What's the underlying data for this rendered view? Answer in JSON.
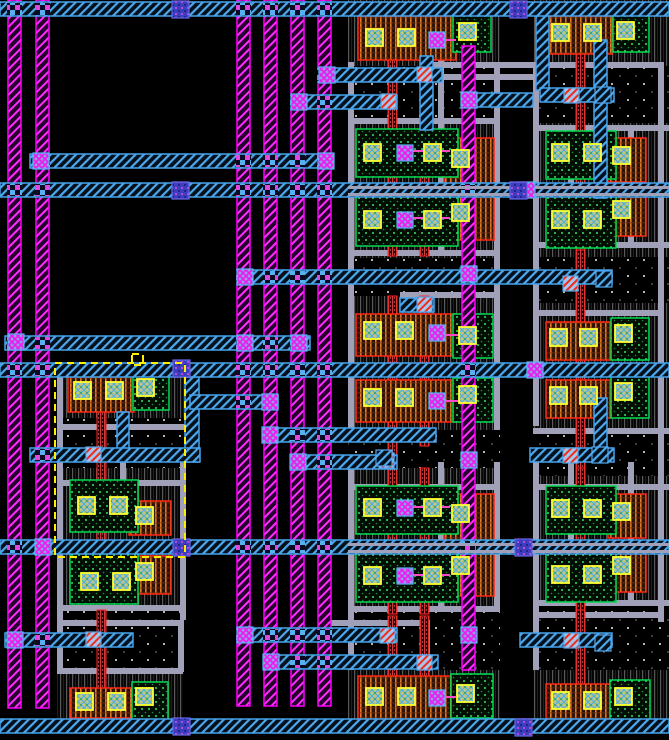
{
  "canvas": {
    "width": 669,
    "height": 740,
    "background": "#000000"
  },
  "palette": {
    "metal2_magenta": "#ff00ff",
    "metal1_cyan": "#46a4ec",
    "routing_gray": "#a0a0b8",
    "poly_red": "#ff2424",
    "pmos_orange": "#e07824",
    "nmos_green": "#00dc50",
    "contact_yellow": "#ffff30",
    "via3_indigo": "#3d3dc0",
    "selection_yellow": "#ffee00",
    "background": "#000000"
  },
  "layers": {
    "wells": [
      [
        348,
        0,
        152,
        66
      ],
      [
        533,
        0,
        136,
        66
      ],
      [
        348,
        118,
        152,
        140
      ],
      [
        533,
        123,
        136,
        134
      ],
      [
        348,
        296,
        152,
        134
      ],
      [
        533,
        303,
        136,
        130
      ],
      [
        348,
        468,
        152,
        142
      ],
      [
        533,
        476,
        136,
        130
      ],
      [
        348,
        670,
        152,
        58
      ],
      [
        533,
        670,
        136,
        58
      ],
      [
        57,
        364,
        128,
        54
      ],
      [
        57,
        468,
        128,
        142
      ],
      [
        57,
        670,
        126,
        50
      ]
    ],
    "stipples": [
      [
        348,
        66,
        152,
        52
      ],
      [
        533,
        66,
        136,
        57
      ],
      [
        348,
        258,
        152,
        38
      ],
      [
        533,
        257,
        136,
        46
      ],
      [
        348,
        430,
        152,
        38
      ],
      [
        533,
        433,
        136,
        43
      ],
      [
        348,
        610,
        152,
        60
      ],
      [
        533,
        606,
        136,
        64
      ],
      [
        57,
        418,
        128,
        50
      ],
      [
        57,
        610,
        128,
        60
      ]
    ],
    "grayH": [
      [
        428,
        62,
        235
      ],
      [
        428,
        74,
        118
      ],
      [
        348,
        118,
        152
      ],
      [
        348,
        250,
        152
      ],
      [
        533,
        125,
        136
      ],
      [
        533,
        242,
        136
      ],
      [
        348,
        484,
        152
      ],
      [
        348,
        606,
        152
      ],
      [
        533,
        484,
        136
      ],
      [
        533,
        600,
        136
      ],
      [
        57,
        424,
        128
      ],
      [
        57,
        480,
        126
      ],
      [
        57,
        605,
        126
      ],
      [
        57,
        620,
        126
      ],
      [
        57,
        668,
        126
      ],
      [
        330,
        620,
        98
      ],
      [
        533,
        612,
        127
      ],
      [
        400,
        292,
        94
      ],
      [
        533,
        310,
        127
      ],
      [
        533,
        428,
        136
      ]
    ],
    "grayV": [
      [
        348,
        62,
        366
      ],
      [
        348,
        462,
        208
      ],
      [
        494,
        62,
        368
      ],
      [
        494,
        462,
        148
      ],
      [
        438,
        56,
        196
      ],
      [
        438,
        462,
        148
      ],
      [
        533,
        62,
        364
      ],
      [
        533,
        462,
        208
      ],
      [
        658,
        62,
        560
      ],
      [
        568,
        125,
        120
      ],
      [
        568,
        462,
        140
      ],
      [
        628,
        125,
        120
      ],
      [
        628,
        462,
        140
      ],
      [
        57,
        364,
        256
      ],
      [
        180,
        462,
        158
      ],
      [
        57,
        620,
        52
      ],
      [
        178,
        620,
        52
      ],
      [
        120,
        424,
        60
      ],
      [
        424,
        620,
        52
      ]
    ],
    "redpolys": [
      [
        388,
        16,
        9,
        114
      ],
      [
        420,
        16,
        9,
        114
      ],
      [
        388,
        130,
        9,
        126
      ],
      [
        420,
        130,
        9,
        126
      ],
      [
        388,
        296,
        9,
        172
      ],
      [
        420,
        296,
        9,
        150
      ],
      [
        388,
        468,
        9,
        146
      ],
      [
        420,
        468,
        9,
        146
      ],
      [
        388,
        616,
        9,
        106
      ],
      [
        420,
        616,
        9,
        106
      ],
      [
        576,
        16,
        9,
        118
      ],
      [
        576,
        134,
        9,
        116
      ],
      [
        576,
        250,
        9,
        218
      ],
      [
        576,
        468,
        9,
        142
      ],
      [
        576,
        610,
        9,
        112
      ],
      [
        97,
        374,
        9,
        186
      ],
      [
        97,
        610,
        9,
        110
      ]
    ],
    "pboxes": [
      [
        358,
        16,
        98,
        44
      ],
      [
        444,
        138,
        50,
        50
      ],
      [
        444,
        192,
        50,
        48
      ],
      [
        356,
        314,
        100,
        42
      ],
      [
        356,
        380,
        100,
        42
      ],
      [
        444,
        494,
        50,
        50
      ],
      [
        444,
        548,
        50,
        48
      ],
      [
        358,
        676,
        98,
        44
      ],
      [
        546,
        16,
        66,
        38
      ],
      [
        608,
        138,
        38,
        44
      ],
      [
        608,
        192,
        38,
        44
      ],
      [
        546,
        322,
        64,
        38
      ],
      [
        546,
        380,
        64,
        38
      ],
      [
        608,
        494,
        38,
        44
      ],
      [
        608,
        548,
        38,
        44
      ],
      [
        546,
        684,
        66,
        38
      ],
      [
        68,
        374,
        66,
        38
      ],
      [
        129,
        501,
        42,
        34
      ],
      [
        129,
        556,
        42,
        38
      ],
      [
        70,
        688,
        64,
        30
      ]
    ],
    "gboxes": [
      [
        453,
        14,
        38,
        38
      ],
      [
        356,
        129,
        102,
        48
      ],
      [
        356,
        196,
        102,
        50
      ],
      [
        453,
        314,
        40,
        44
      ],
      [
        453,
        378,
        40,
        44
      ],
      [
        356,
        486,
        102,
        48
      ],
      [
        356,
        552,
        102,
        50
      ],
      [
        451,
        674,
        42,
        44
      ],
      [
        613,
        14,
        36,
        38
      ],
      [
        546,
        131,
        70,
        48
      ],
      [
        546,
        196,
        70,
        52
      ],
      [
        611,
        318,
        38,
        42
      ],
      [
        611,
        376,
        38,
        42
      ],
      [
        546,
        486,
        70,
        48
      ],
      [
        546,
        552,
        70,
        50
      ],
      [
        610,
        680,
        40,
        40
      ],
      [
        133,
        372,
        36,
        38
      ],
      [
        70,
        480,
        68,
        52
      ],
      [
        70,
        552,
        68,
        52
      ],
      [
        132,
        682,
        36,
        38
      ]
    ],
    "cyanVs": [
      [
        420,
        56,
        13,
        74
      ],
      [
        536,
        10,
        13,
        80
      ],
      [
        594,
        40,
        13,
        158
      ],
      [
        594,
        398,
        13,
        64
      ],
      [
        185,
        377,
        14,
        85
      ],
      [
        117,
        412,
        12,
        50
      ]
    ],
    "vstripes": [
      [
        8,
        0,
        13,
        708
      ],
      [
        36,
        0,
        13,
        708
      ],
      [
        237,
        0,
        13,
        706
      ],
      [
        264,
        0,
        13,
        706
      ],
      [
        291,
        0,
        13,
        706
      ],
      [
        318,
        0,
        13,
        706
      ],
      [
        462,
        46,
        13,
        624
      ]
    ],
    "hbuses": [
      [
        0,
        2,
        669,
        14
      ],
      [
        318,
        68,
        124,
        14
      ],
      [
        291,
        95,
        106,
        14
      ],
      [
        475,
        93,
        58,
        14
      ],
      [
        540,
        88,
        74,
        14
      ],
      [
        30,
        154,
        302,
        14
      ],
      [
        0,
        183,
        669,
        14
      ],
      [
        237,
        270,
        375,
        14
      ],
      [
        400,
        298,
        34,
        14
      ],
      [
        5,
        336,
        305,
        14
      ],
      [
        0,
        363,
        669,
        14
      ],
      [
        190,
        395,
        88,
        14
      ],
      [
        264,
        428,
        172,
        14
      ],
      [
        291,
        455,
        106,
        14
      ],
      [
        30,
        448,
        170,
        14
      ],
      [
        530,
        448,
        84,
        14
      ],
      [
        0,
        540,
        669,
        14
      ],
      [
        237,
        628,
        160,
        14
      ],
      [
        264,
        655,
        174,
        14
      ],
      [
        520,
        633,
        92,
        14
      ],
      [
        5,
        633,
        128,
        14
      ],
      [
        0,
        719,
        669,
        14
      ]
    ],
    "grayDashes": [
      [
        348,
        186,
        321,
        3
      ],
      [
        348,
        193,
        321,
        3
      ],
      [
        348,
        543,
        321,
        3
      ],
      [
        348,
        550,
        321,
        3
      ]
    ],
    "pinksegs": [
      [
        413,
        151,
        450,
        151
      ],
      [
        413,
        218,
        450,
        218
      ],
      [
        413,
        507,
        450,
        507
      ],
      [
        413,
        575,
        450,
        575
      ],
      [
        445,
        335,
        460,
        335
      ],
      [
        445,
        401,
        460,
        401
      ],
      [
        445,
        40,
        456,
        40
      ],
      [
        445,
        697,
        456,
        697
      ]
    ],
    "ycontacts": [
      [
        366,
        29
      ],
      [
        398,
        29
      ],
      [
        459,
        23
      ],
      [
        364,
        144
      ],
      [
        424,
        144
      ],
      [
        452,
        150
      ],
      [
        364,
        211
      ],
      [
        424,
        211
      ],
      [
        452,
        204
      ],
      [
        364,
        322
      ],
      [
        396,
        322
      ],
      [
        459,
        327
      ],
      [
        364,
        389
      ],
      [
        396,
        389
      ],
      [
        459,
        386
      ],
      [
        364,
        499
      ],
      [
        424,
        499
      ],
      [
        452,
        505
      ],
      [
        364,
        567
      ],
      [
        424,
        567
      ],
      [
        452,
        557
      ],
      [
        366,
        688
      ],
      [
        398,
        688
      ],
      [
        457,
        685
      ],
      [
        552,
        24
      ],
      [
        584,
        24
      ],
      [
        617,
        22
      ],
      [
        552,
        144
      ],
      [
        584,
        144
      ],
      [
        613,
        147
      ],
      [
        552,
        211
      ],
      [
        584,
        211
      ],
      [
        613,
        201
      ],
      [
        550,
        329
      ],
      [
        580,
        329
      ],
      [
        615,
        325
      ],
      [
        550,
        387
      ],
      [
        580,
        387
      ],
      [
        615,
        383
      ],
      [
        552,
        500
      ],
      [
        584,
        500
      ],
      [
        613,
        503
      ],
      [
        552,
        566
      ],
      [
        584,
        566
      ],
      [
        613,
        557
      ],
      [
        552,
        692
      ],
      [
        584,
        692
      ],
      [
        615,
        688
      ],
      [
        74,
        382
      ],
      [
        106,
        382
      ],
      [
        137,
        379
      ],
      [
        78,
        497
      ],
      [
        110,
        497
      ],
      [
        136,
        507
      ],
      [
        81,
        573
      ],
      [
        113,
        573
      ],
      [
        136,
        563
      ],
      [
        76,
        693
      ],
      [
        108,
        693
      ],
      [
        136,
        688
      ]
    ],
    "mvias": [
      [
        319,
        67
      ],
      [
        291,
        94
      ],
      [
        461,
        92
      ],
      [
        33,
        153
      ],
      [
        318,
        153
      ],
      [
        237,
        269
      ],
      [
        461,
        266
      ],
      [
        8,
        334
      ],
      [
        237,
        335
      ],
      [
        291,
        335
      ],
      [
        527,
        362
      ],
      [
        262,
        394
      ],
      [
        262,
        427
      ],
      [
        290,
        454
      ],
      [
        35,
        539
      ],
      [
        237,
        627
      ],
      [
        263,
        654
      ],
      [
        7,
        632
      ],
      [
        519,
        182
      ],
      [
        397,
        145
      ],
      [
        397,
        212
      ],
      [
        429,
        32
      ],
      [
        429,
        325
      ],
      [
        429,
        393
      ],
      [
        397,
        500
      ],
      [
        397,
        568
      ],
      [
        429,
        690
      ],
      [
        461,
        452
      ],
      [
        461,
        627
      ]
    ],
    "rcontacts": [
      [
        417,
        67
      ],
      [
        381,
        94
      ],
      [
        564,
        88
      ],
      [
        563,
        276
      ],
      [
        417,
        297
      ],
      [
        86,
        447
      ],
      [
        563,
        448
      ],
      [
        379,
        453
      ],
      [
        86,
        632
      ],
      [
        380,
        628
      ],
      [
        417,
        655
      ],
      [
        564,
        633
      ]
    ],
    "bvias": [
      [
        172,
        1
      ],
      [
        510,
        1
      ],
      [
        172,
        182
      ],
      [
        510,
        182
      ],
      [
        173,
        360
      ],
      [
        173,
        539
      ],
      [
        515,
        539
      ],
      [
        173,
        718
      ],
      [
        515,
        719
      ]
    ],
    "cyanboxes": [
      [
        595,
        87
      ],
      [
        596,
        271
      ],
      [
        592,
        447
      ],
      [
        595,
        635
      ],
      [
        376,
        450
      ]
    ],
    "selection": {
      "rect": [
        55,
        363,
        130,
        194
      ],
      "handle": [
        132,
        354,
        11,
        11
      ]
    }
  }
}
